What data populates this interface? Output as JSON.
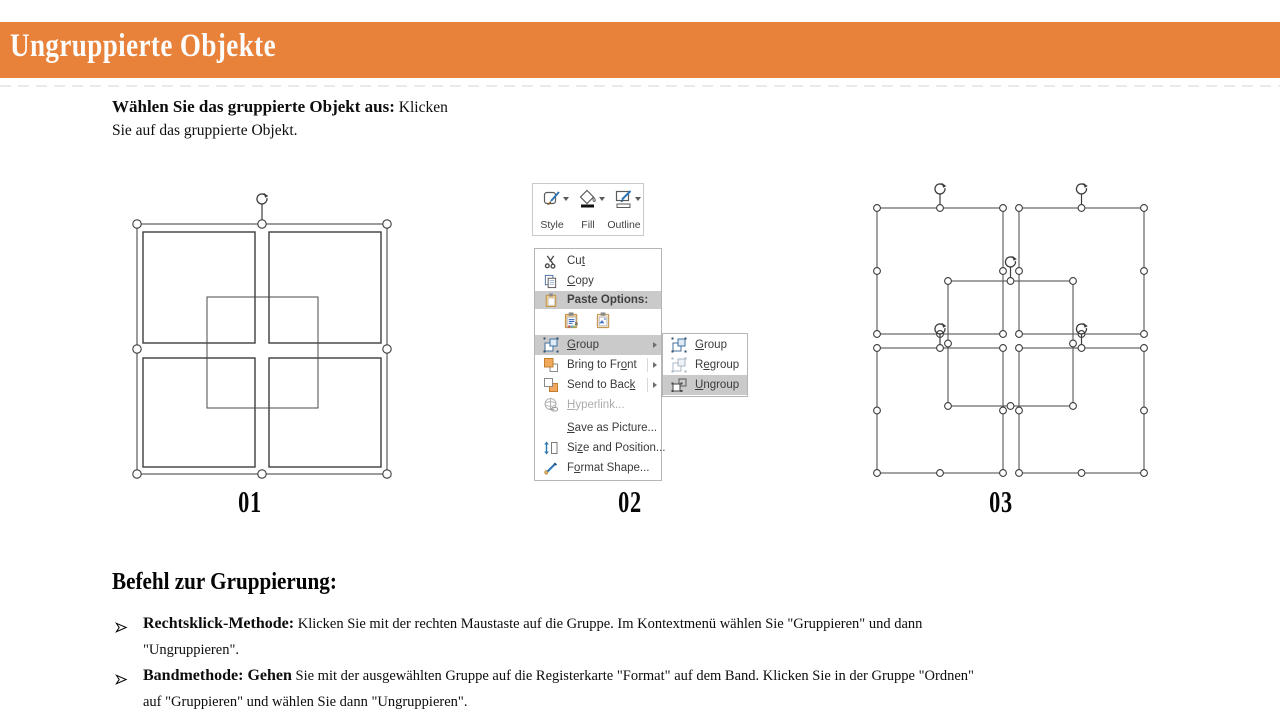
{
  "header": {
    "title": "Ungruppierte Objekte"
  },
  "intro": {
    "lead": "Wählen Sie das gruppierte Objekt aus:",
    "rest": " Klicken Sie auf das gruppierte Objekt."
  },
  "figures": {
    "label_01": "01",
    "label_02": "02",
    "label_03": "03"
  },
  "mini_toolbar": {
    "buttons": [
      {
        "label": "Style",
        "icon": "shape-style-icon"
      },
      {
        "label": "Fill",
        "icon": "shape-fill-icon"
      },
      {
        "label": "Outline",
        "icon": "shape-outline-icon"
      }
    ]
  },
  "context_menu": {
    "items": [
      {
        "type": "item",
        "label": "Cut",
        "underline": 2,
        "icon": "scissors-icon"
      },
      {
        "type": "item",
        "label": "Copy",
        "underline": 0,
        "icon": "copy-icon"
      },
      {
        "type": "header",
        "label": "Paste Options:",
        "icon": "clipboard-icon",
        "highlight": true
      },
      {
        "type": "paste-row",
        "options": [
          {
            "name": "paste-keep-source-formatting",
            "icon": "paste-keep-source-icon"
          },
          {
            "name": "paste-as-picture",
            "icon": "paste-picture-icon"
          }
        ]
      },
      {
        "type": "item",
        "label": "Group",
        "underline": 0,
        "icon": "group-icon",
        "submenu": true,
        "highlight": true
      },
      {
        "type": "item",
        "label": "Bring to Front",
        "underline": 11,
        "icon": "bring-to-front-icon",
        "submenu": true
      },
      {
        "type": "item",
        "label": "Send to Back",
        "underline": 11,
        "icon": "send-to-back-icon",
        "submenu": true
      },
      {
        "type": "item",
        "label": "Hyperlink...",
        "underline": 0,
        "icon": "hyperlink-icon",
        "disabled": true
      },
      {
        "type": "item",
        "label": "Save as Picture...",
        "underline": 0,
        "icon": null,
        "spacer": true
      },
      {
        "type": "item",
        "label": "Size and Position...",
        "underline": 2,
        "icon": "size-position-icon"
      },
      {
        "type": "item",
        "label": "Format Shape...",
        "underline": 1,
        "icon": "format-shape-icon"
      }
    ]
  },
  "group_submenu": {
    "items": [
      {
        "label": "Group",
        "underline": 0,
        "icon": "group-icon"
      },
      {
        "label": "Regroup",
        "underline": 1,
        "icon": "regroup-icon"
      },
      {
        "label": "Ungroup",
        "underline": 0,
        "icon": "ungroup-icon",
        "highlight": true
      }
    ]
  },
  "section": {
    "heading": "Befehl zur Gruppierung:",
    "bullets": [
      {
        "lead": "Rechtsklick-Methode:",
        "rest": " Klicken Sie mit der rechten Maustaste auf die Gruppe. Im Kontextmenü wählen Sie \"Gruppieren\" und dann \"Ungruppieren\"."
      },
      {
        "lead": "Bandmethode: Gehen",
        "rest": " Sie mit der ausgewählten Gruppe auf die Registerkarte \"Format\" auf dem Band. Klicken Sie in der Gruppe \"Ordnen\" auf \"Gruppieren\" und wählen Sie dann \"Ungruppieren\"."
      }
    ]
  },
  "colors": {
    "accent_orange": "#E8813A",
    "menu_highlight": "#CACACA"
  }
}
